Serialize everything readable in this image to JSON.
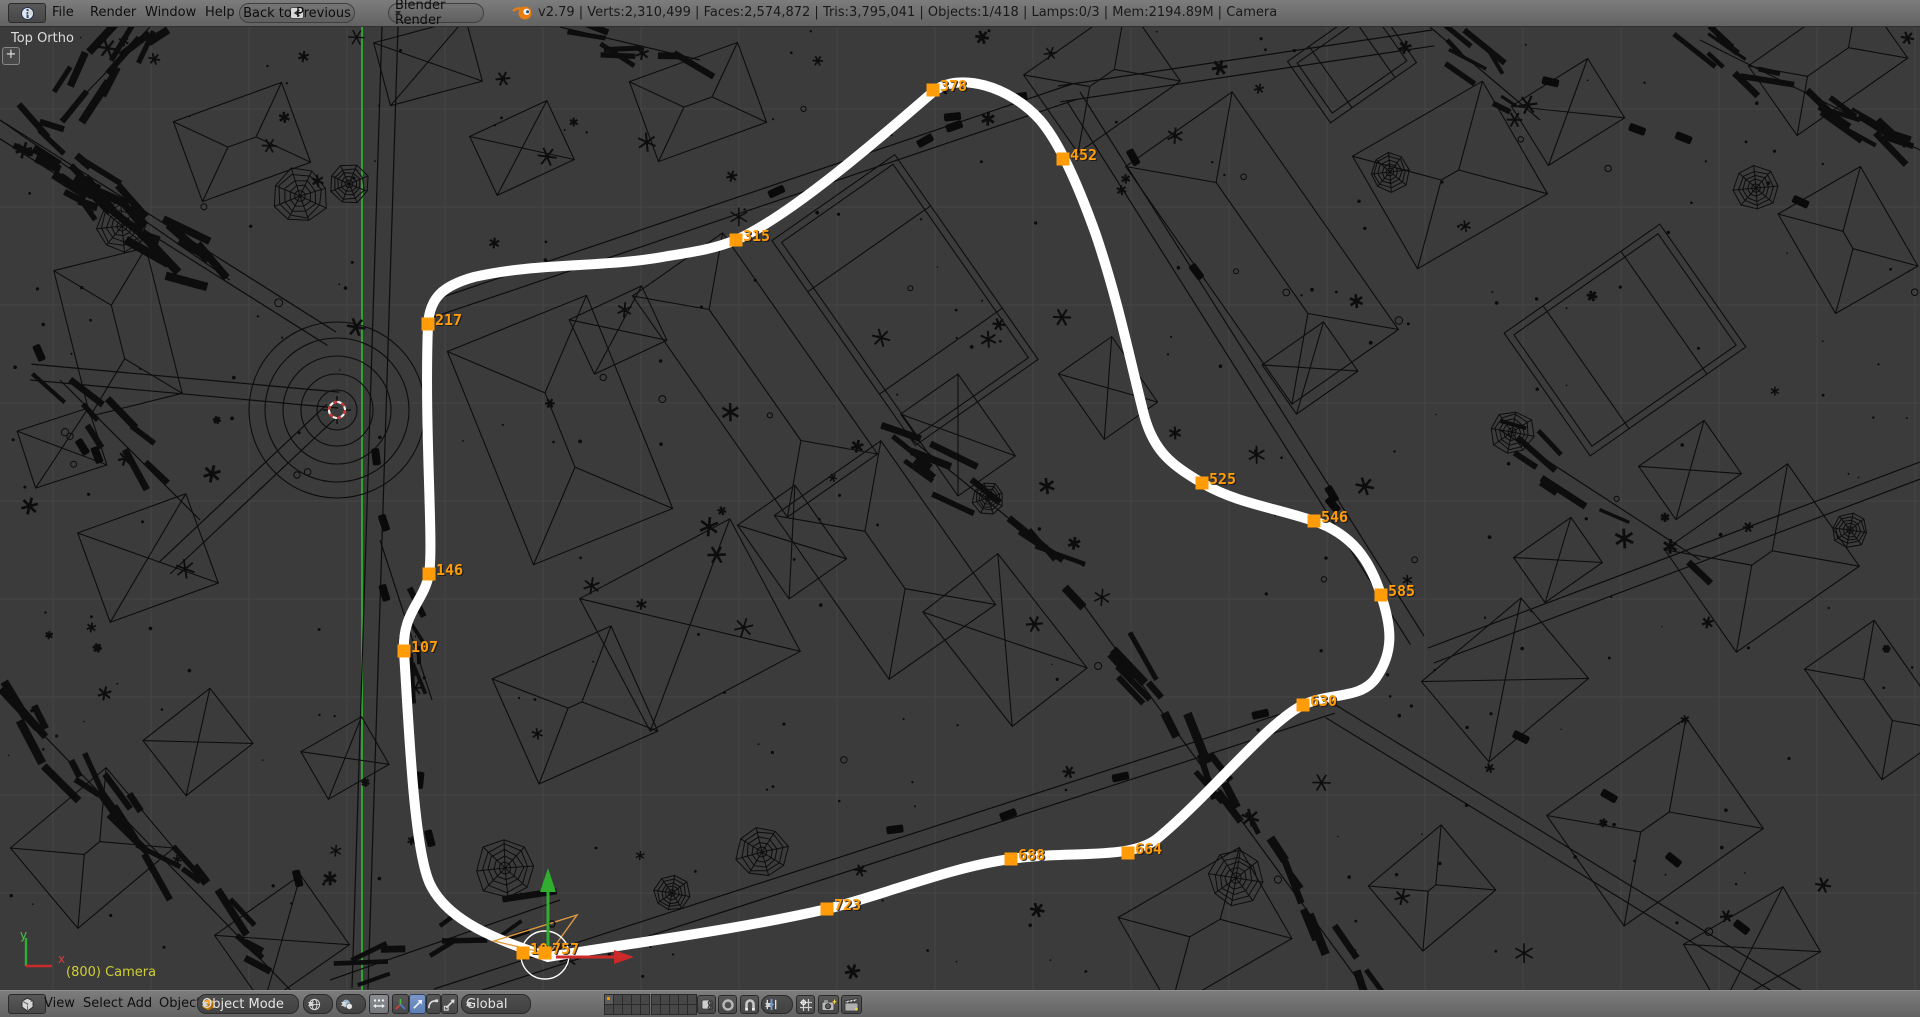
{
  "header": {
    "menus": [
      "File",
      "Render",
      "Window",
      "Help"
    ],
    "back_button": "Back to Previous",
    "engine_select": "Blender Render",
    "stats": "v2.79 | Verts:2,310,499 | Faces:2,574,872 | Tris:3,795,041 | Objects:1/418 | Lamps:0/3 | Mem:2194.89M | Camera"
  },
  "viewport": {
    "view_label": "Top Ortho",
    "camera_label": "(800) Camera",
    "expand_button": "+",
    "axis_gizmo": {
      "x_label": "x",
      "y_label": "y"
    },
    "markers": [
      {
        "frame": "10",
        "x": 523,
        "y": 953
      },
      {
        "frame": "107",
        "x": 404,
        "y": 651
      },
      {
        "frame": "146",
        "x": 429,
        "y": 574
      },
      {
        "frame": "217",
        "x": 428,
        "y": 324
      },
      {
        "frame": "315",
        "x": 736,
        "y": 240
      },
      {
        "frame": "378",
        "x": 933,
        "y": 90
      },
      {
        "frame": "452",
        "x": 1063,
        "y": 159
      },
      {
        "frame": "525",
        "x": 1202,
        "y": 483
      },
      {
        "frame": "546",
        "x": 1314,
        "y": 521
      },
      {
        "frame": "585",
        "x": 1381,
        "y": 595
      },
      {
        "frame": "630",
        "x": 1303,
        "y": 705
      },
      {
        "frame": "664",
        "x": 1128,
        "y": 853
      },
      {
        "frame": "688",
        "x": 1011,
        "y": 859
      },
      {
        "frame": "723",
        "x": 827,
        "y": 909
      },
      {
        "frame": "757",
        "x": 545,
        "y": 953
      }
    ],
    "path_d": "M 548 957 C 498 940, 448 922, 430 884 C 414 850, 409 730, 404 651 C 402 612, 424 602, 429 574 C 434 545, 424 430, 428 324 C 430 298, 442 286, 474 277 C 540 262, 606 268, 668 256 C 700 251, 716 248, 736 240 C 790 216, 880 138, 933 92 C 958 71, 1010 86, 1040 120 C 1060 143, 1080 190, 1096 235 C 1118 300, 1130 360, 1144 415 C 1154 452, 1172 465, 1202 483 C 1236 503, 1276 508, 1314 521 C 1352 534, 1370 560, 1381 595 C 1392 628, 1394 652, 1376 678 C 1360 700, 1330 692, 1303 705 C 1268 722, 1210 795, 1158 838 C 1130 861, 1070 850, 1011 859 C 950 867, 884 895, 827 909 C 740 929, 640 942, 548 957 Z",
    "colors": {
      "background": "#3b3b3b",
      "grid": "#464646",
      "wireframe": "#0d0d0d",
      "path": "#ffffff",
      "marker": "#ff9c08",
      "camera_label": "#cfcf35",
      "axis_green": "#2fae2f",
      "axis_red": "#cc2a2a"
    }
  },
  "footer": {
    "menus": [
      "View",
      "Select",
      "Add",
      "Object"
    ],
    "mode_select": "Object Mode",
    "orientation_select": "Global"
  },
  "icons": [
    "info-icon",
    "back-arrow-icon",
    "blender-logo-icon",
    "viewport-editor-icon",
    "cube-icon",
    "shading-globe-icon",
    "pivot-icon",
    "manipulate-centers-icon",
    "axis-tripod-icon",
    "translate-icon",
    "rotate-icon",
    "scale-icon",
    "lock-scene-icon",
    "proportional-edit-icon",
    "magnet-icon",
    "snap-increment-icon",
    "snap-target-icon",
    "opengl-camera-icon",
    "clapperboard-icon"
  ]
}
